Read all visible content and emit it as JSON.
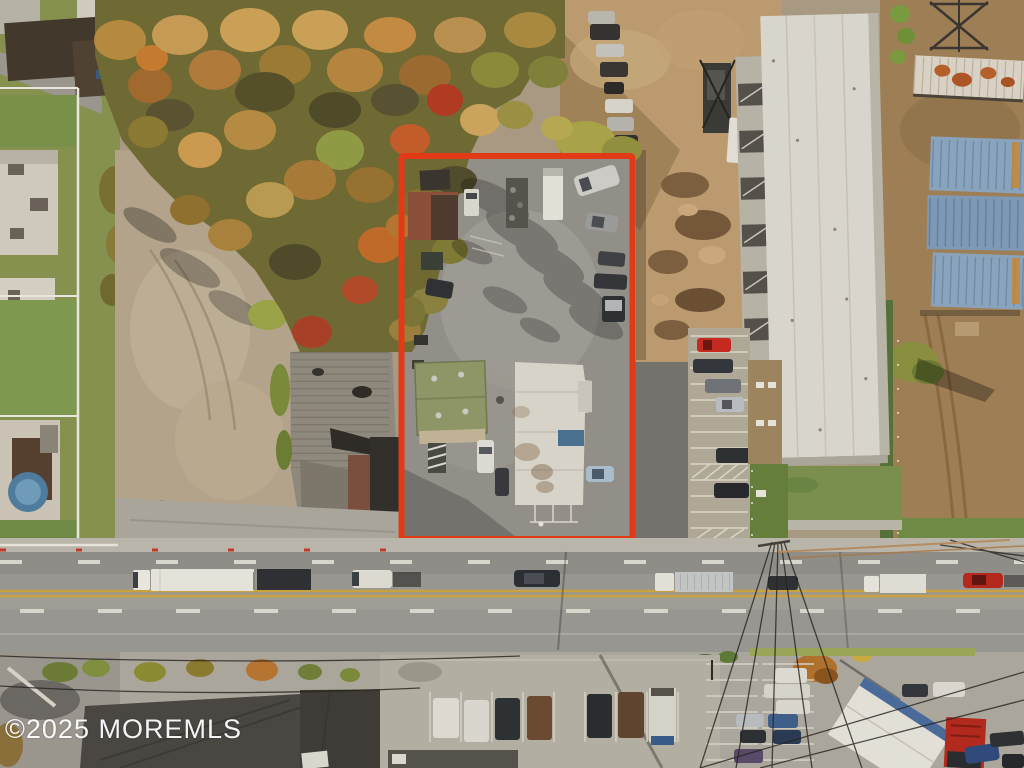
{
  "watermark": {
    "text": "©2025 MOREMLS"
  },
  "boundary": {
    "color": "#e23a17"
  }
}
